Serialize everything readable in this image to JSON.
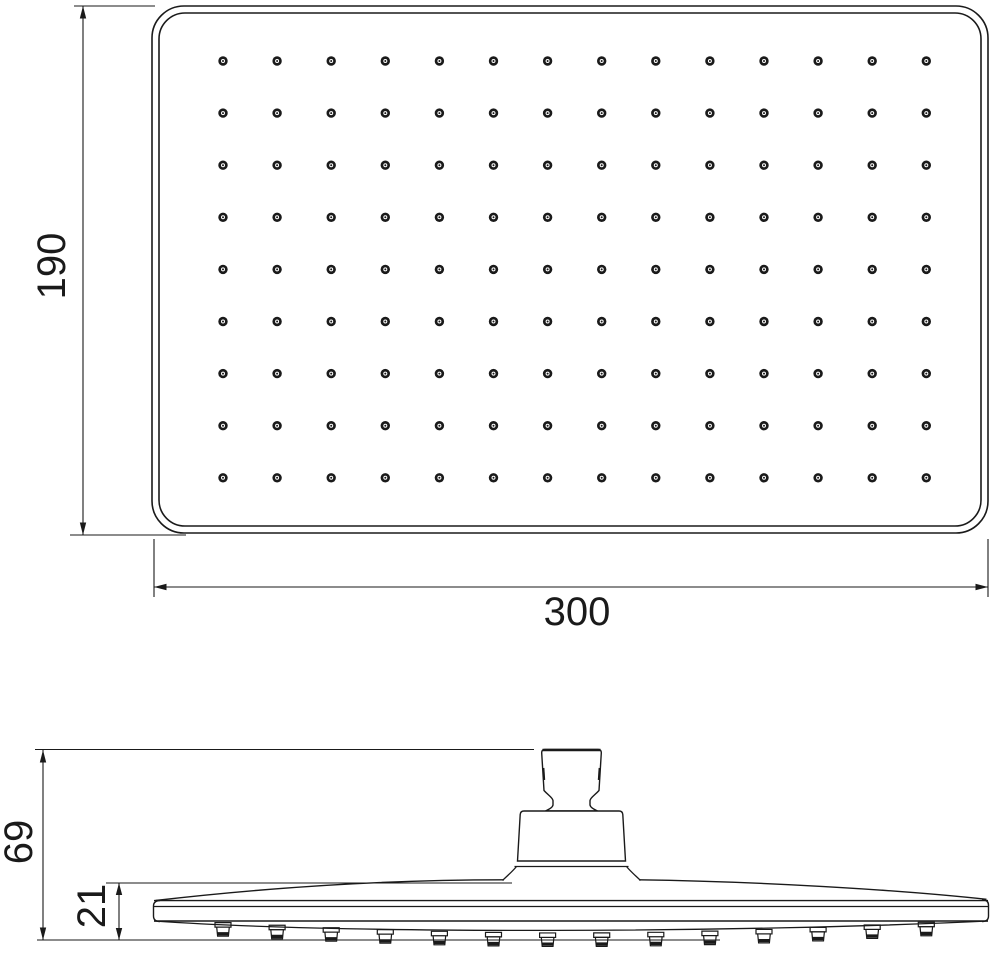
{
  "colors": {
    "line": "#1a1a1a",
    "background": "#ffffff"
  },
  "top_view": {
    "height_label": "190",
    "width_label": "300",
    "hole_grid": {
      "columns": 14,
      "rows": 9
    }
  },
  "side_view": {
    "total_height_label": "69",
    "head_thickness_label": "21",
    "nozzle_count": 14
  }
}
